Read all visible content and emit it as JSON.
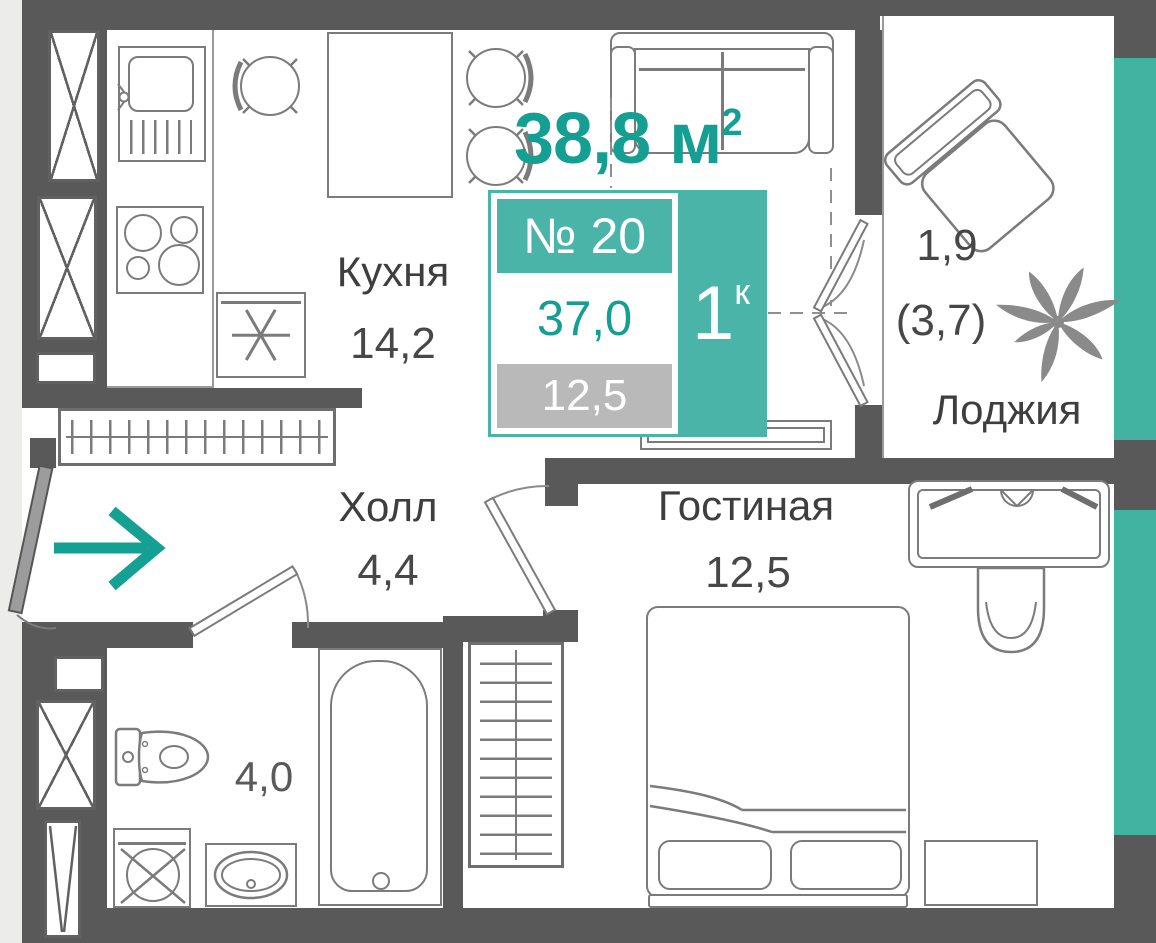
{
  "unit": {
    "total_area": "38,8",
    "area_unit": "м",
    "area_sup": "2",
    "number": "№ 20",
    "rooms_count": "1",
    "rooms_suffix": "к",
    "living_area_total": "37,0",
    "reduced_area": "12,5"
  },
  "rooms": {
    "kitchen": {
      "name": "Кухня",
      "area": "14,2"
    },
    "hall": {
      "name": "Холл",
      "area": "4,4"
    },
    "living": {
      "name": "Гостиная",
      "area": "12,5"
    },
    "bathroom": {
      "area": "4,0"
    },
    "loggia": {
      "name": "Лоджия",
      "area": "1,9",
      "area_with_coefficient": "(3,7)"
    }
  },
  "colors": {
    "accent_teal": "#159f92",
    "panel_teal": "#49b4a7",
    "facade_stripe_teal": "#43b3a1",
    "wall_gray": "#595959",
    "badge_gray": "#b9b9b9",
    "furniture_outline": "#7b7b7b"
  },
  "icons": {
    "entry_arrow": "entrance-direction-arrow-icon",
    "furniture": [
      "kitchen-sink-icon",
      "stove-icon",
      "fridge-icon",
      "dining-table-icon",
      "chair-icon",
      "sofa-icon",
      "armchair-icon",
      "palm-plant-icon",
      "wardrobe-icon",
      "desk-icon",
      "desk-chair-icon",
      "double-bed-icon",
      "nightstand-icon",
      "bathtub-icon",
      "toilet-icon",
      "washing-machine-icon",
      "bathroom-sink-icon",
      "ventilation-shaft-icon",
      "tv-console-icon"
    ]
  }
}
